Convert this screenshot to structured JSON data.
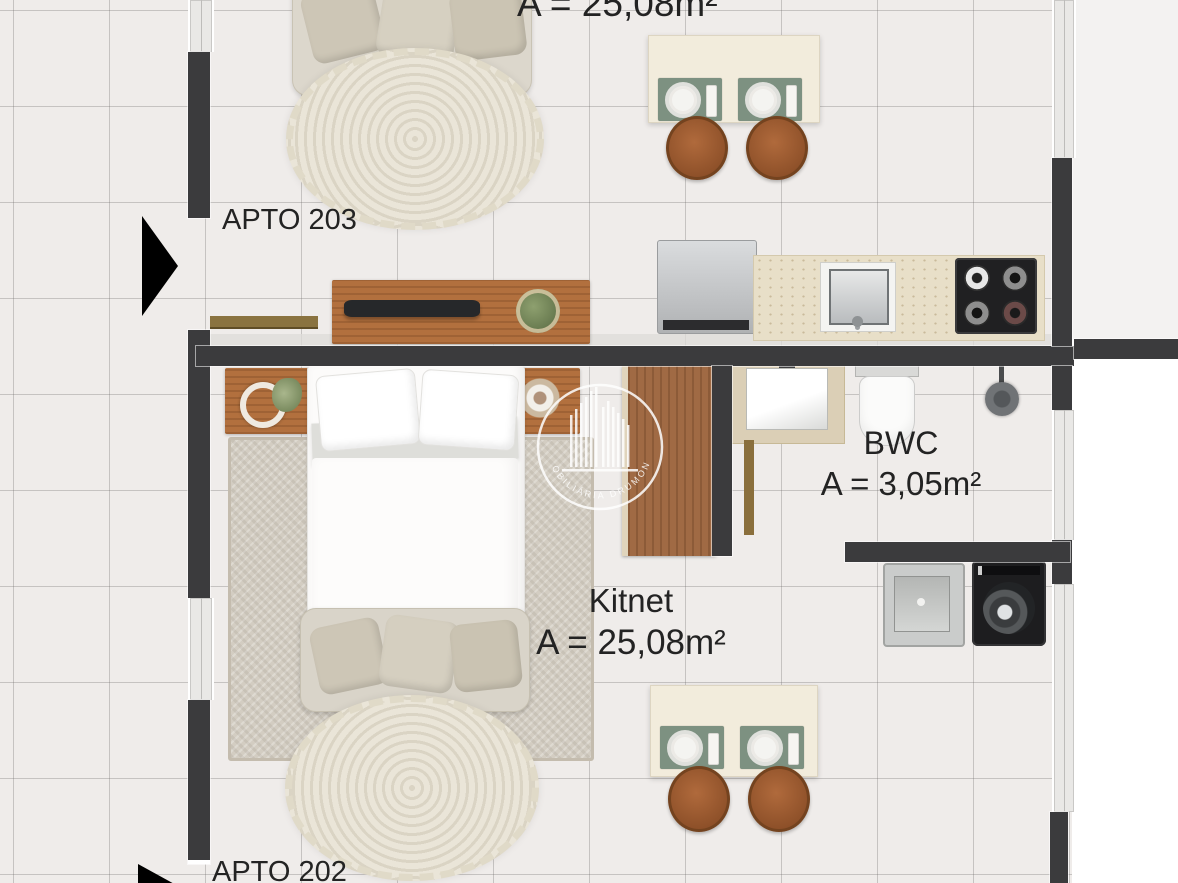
{
  "watermark": {
    "text": "IMOBILIÁRIA DRUMOND"
  },
  "labels": {
    "apto_203": "APTO 203",
    "apto_202": "APTO 202",
    "top_unit_area": "A = 25,08m²",
    "kitnet_name": "Kitnet",
    "kitnet_area": "A = 25,08m²",
    "bwc_name": "BWC",
    "bwc_area": "A = 3,05m²"
  },
  "colors": {
    "wall": "#3b3b3d",
    "floor": "#efecea",
    "wood": "#b2703e",
    "counter": "#e8dfc8",
    "placemat": "#7d9181",
    "chair": "#a05f33",
    "text": "#232323",
    "watermark": "#ffffff"
  }
}
